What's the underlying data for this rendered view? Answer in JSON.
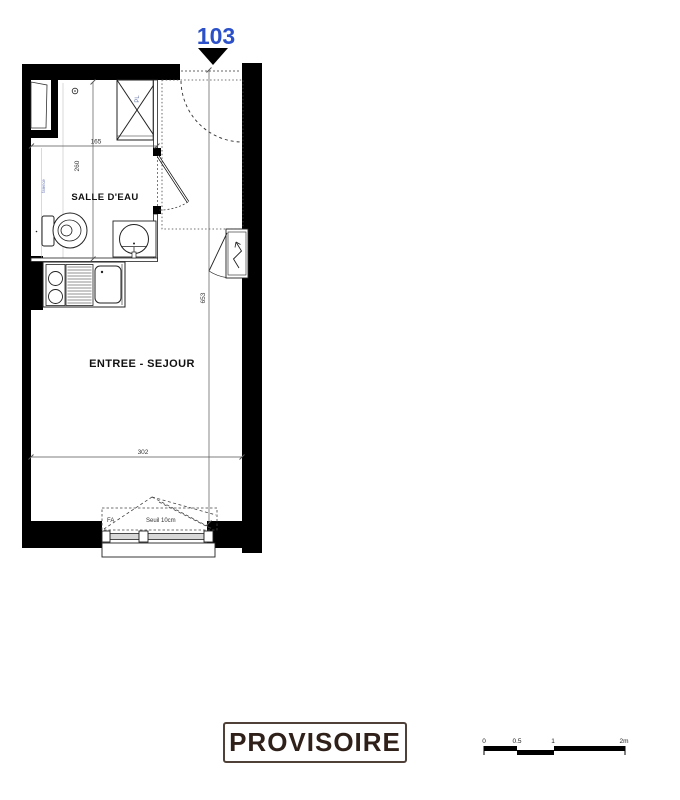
{
  "plan": {
    "unit_number": "103",
    "rooms": {
      "bathroom": "SALLE D'EAU",
      "living": "ENTREE - SEJOUR"
    },
    "annotations": {
      "closet": "PL",
      "window": "FA",
      "threshold": "Seuil 10cm",
      "wall_note": "faïence"
    },
    "dimensions": {
      "bathroom_width_cm": "165",
      "bathroom_depth_cm": "260",
      "unit_length_cm": "653",
      "unit_width_cm": "302"
    }
  },
  "stamp": {
    "label": "PROVISOIRE"
  },
  "scale_bar": {
    "ticks": [
      "0",
      "0.5",
      "1",
      "2m"
    ]
  },
  "colors": {
    "unit_number_blue": "#2b50c8",
    "stamp_text": "#30201a",
    "stamp_border": "#4f4138",
    "wall_black": "#000000",
    "window_pane_gray": "#d8d8d8"
  }
}
